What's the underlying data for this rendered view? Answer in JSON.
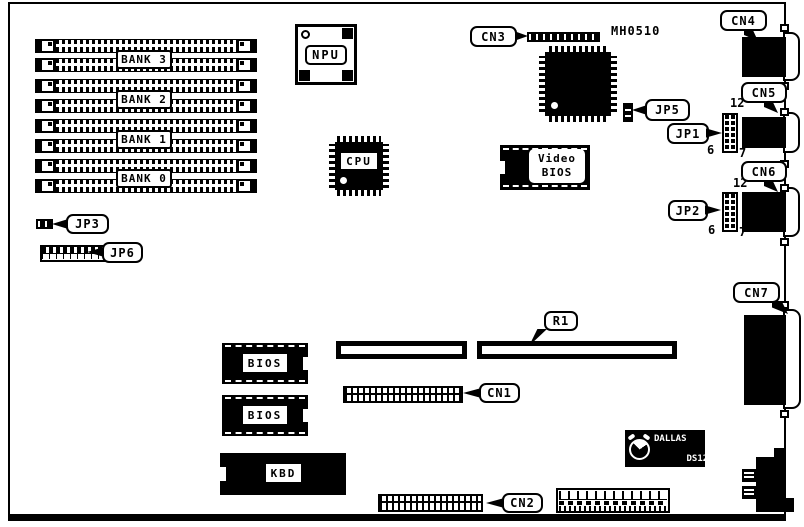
{
  "board": {
    "part_number": "MH0510"
  },
  "colors": {
    "ink": "#000000",
    "paper": "#ffffff"
  },
  "memory": {
    "bank_labels": [
      "BANK 3",
      "BANK 2",
      "BANK 1",
      "BANK 0"
    ]
  },
  "chips": {
    "npu": "NPU",
    "cpu": "CPU",
    "video_bios": {
      "line1": "Video",
      "line2": "BIOS"
    },
    "bios_top": "BIOS",
    "bios_bottom": "BIOS",
    "keyboard_controller": "KBD",
    "rtc": {
      "line1": "DALLAS",
      "line2": "DS1225",
      "line3": "REAL TIME"
    }
  },
  "callouts": {
    "cn1": "CN1",
    "cn2": "CN2",
    "cn3": "CN3",
    "cn4": "CN4",
    "cn5": "CN5",
    "cn6": "CN6",
    "cn7": "CN7",
    "jp1": "JP1",
    "jp2": "JP2",
    "jp3": "JP3",
    "jp5": "JP5",
    "jp6": "JP6",
    "r1": "R1"
  },
  "pin_numbers": {
    "jp1": {
      "top": "12",
      "bottom_left": "6",
      "bottom_right": "7"
    },
    "jp2": {
      "top": "12",
      "bottom_left": "6",
      "bottom_right": "7"
    }
  }
}
